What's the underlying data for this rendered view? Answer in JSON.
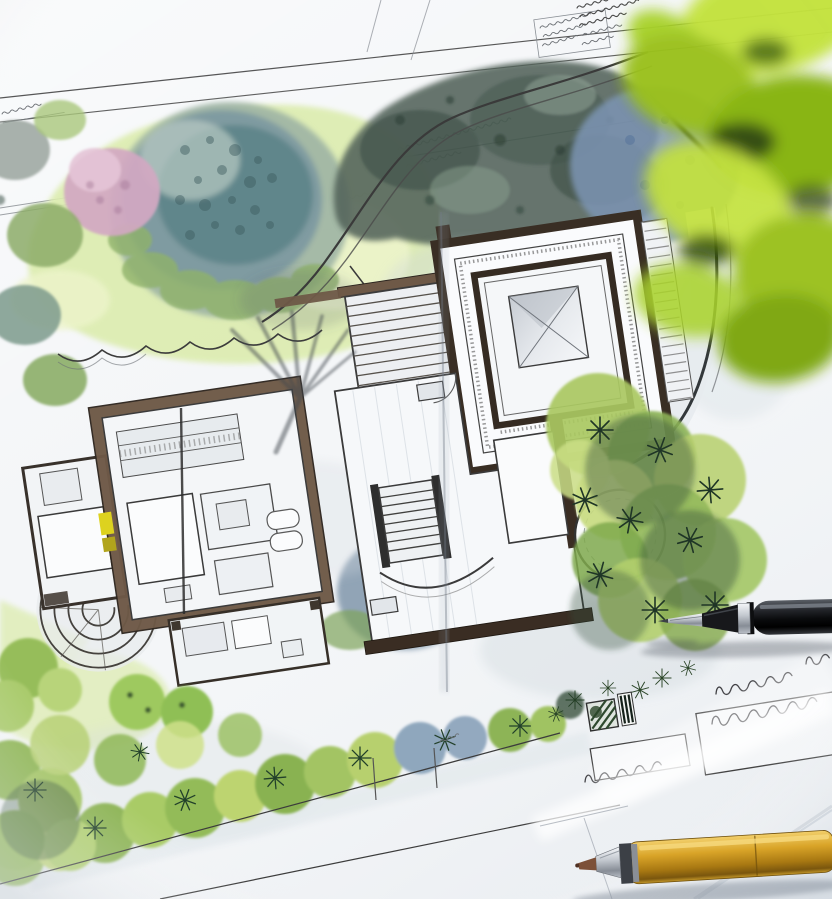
{
  "meta": {
    "title": "Landscape architecture site plan on a desk",
    "alt": "Photograph of a hand-drawn landscape architecture site plan in ink and watercolor: a modern house floor plan with dark brown walls, wooden deck steps, a round patio, a skylight courtyard room, watercolor lawns, blue-green and pink tree canopies, shrub beds and a curved garden path. Illegible handwritten pencil annotations sit along the top edge and in boxes at the lower right. A black fineliner pen lies across the plan on the right, a gold mechanical pencil rests at the bottom edge, and blurred green plant leaves overhang the top right corner."
  },
  "objects": [
    "site plan drawing sheet",
    "house floor plan",
    "wooden deck steps",
    "round patio",
    "skylight courtyard room",
    "lawn",
    "large blue-green tree canopy",
    "pink blossom tree",
    "shrub cluster",
    "hedge planting strip",
    "fan-shaped garden steps",
    "curved garden path",
    "scalloped bed edging",
    "handwritten annotation blocks",
    "legend hatch swatch",
    "black fineliner pen",
    "gold mechanical pencil",
    "blurred foreground plant leaves",
    "desk surface"
  ],
  "colors": {
    "paper": "#f4f6f8",
    "desk": "#eaedf1",
    "ink": "#3a3a3a",
    "scribble": "#4a4a4a",
    "wallDark": "#3a2d23",
    "wallBrown": "#6e5947",
    "lawn": "#dcecae",
    "lawnLight": "#edf4cb",
    "treeCanopyBlue": "#7e9aa0",
    "treeCanopyTeal": "#5d8488",
    "treeDarkGreen": "#53645a",
    "treePink": "#d2a8c2",
    "shrubGreen": "#9cc05e",
    "shrubLight": "#c2d87b",
    "shrubDark": "#2f4a36",
    "blueFoliage": "#8096ab",
    "leafBright": "#9ac01f",
    "leafLight": "#c3e23c",
    "leafDark": "#24430a",
    "penBlack": "#141518",
    "metalSilver": "#b9bec6",
    "pencilGold": "#c9961e",
    "leadBrown": "#7c5038",
    "accentYellow": "#ddd21f",
    "creaseShadow": "#6b7480"
  }
}
